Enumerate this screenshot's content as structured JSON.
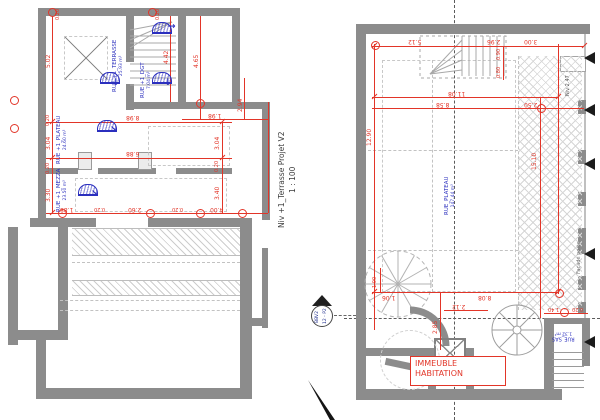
{
  "title_block": {
    "name": "Niv +1_Terrasse Projet   V2",
    "scale": "1 : 100"
  },
  "section_marker": {
    "top": "BBV2",
    "bottom": "12 - P2"
  },
  "colors": {
    "wall": "#8c8c8c",
    "dimension": "#e23528",
    "room_label": "#2b2fbe"
  },
  "left_plan": {
    "rooms": [
      {
        "name": "RUE +1_TERRASSE",
        "area": "25.93 m²"
      },
      {
        "name": "RUE +1_DGT",
        "area": "7.04 m²"
      },
      {
        "name": "RUE +1_PLATEAU",
        "area": "24.60 m²"
      },
      {
        "name": "RUE +1_MEZZA",
        "area": "23.50 m²"
      }
    ],
    "dims": {
      "t1": "0.20",
      "t2": "0.20",
      "v1": "5.02",
      "v2": "0.20",
      "v3": "3.04",
      "v4": "0.20",
      "v5": "3.30",
      "s1": "4.42",
      "s2": "4.65",
      "s3": "2.94",
      "s4": "1.98",
      "h1": "8.98",
      "h2": "6.88",
      "rv1": "3.04",
      "rv2": "0.20",
      "rv3": "3.40",
      "b1": "1.88",
      "b2": "0.20",
      "b3": "2.60",
      "b4": "0.20",
      "b5": "4.00"
    }
  },
  "right_plan": {
    "rooms": [
      {
        "name": "RUE_PLATEAU",
        "area": "147.44 m²"
      },
      {
        "name": "RUE_SAS",
        "area": "1.32 m²"
      }
    ],
    "annotation": {
      "line1": "IMMEUBLE",
      "line2": "HABITATION"
    },
    "labels": {
      "niv": "Niv 2.47",
      "facade": "Façade porte"
    },
    "dims": {
      "t1": "5.12",
      "t2": "2.96",
      "t3": "3.00",
      "t4": "0.90",
      "t5": "0.80",
      "h1": "11.08",
      "h2": "8.58",
      "h3": "2.50",
      "v1": "12.90",
      "v2": "15.10",
      "b1": "1.06",
      "b2": "8.08",
      "s1": "1.00",
      "s2": "2.85",
      "s3": "2.12",
      "s4": "1.40",
      "s5": "0.20"
    }
  }
}
